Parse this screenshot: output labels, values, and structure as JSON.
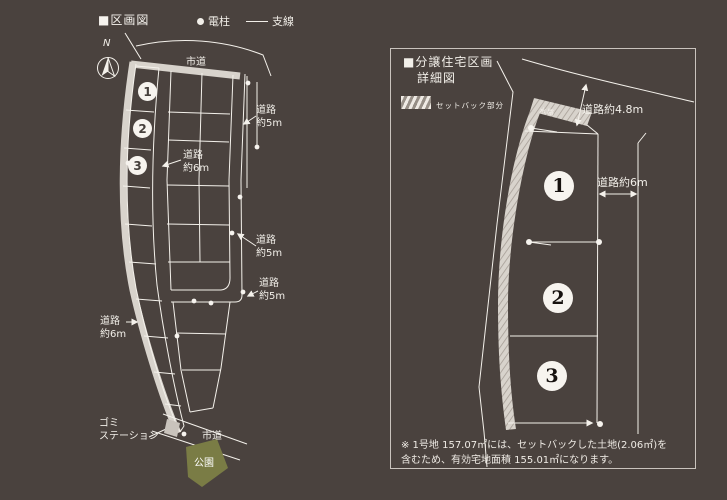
{
  "colors": {
    "background": "#4a423e",
    "line": "#f4f1eb",
    "road_band": "#d8d3cc",
    "park_green": "#7a7c45",
    "box_border": "#c9c3bd"
  },
  "overview": {
    "title": "■区画図",
    "legend": {
      "pole_label": "電柱",
      "wire_label": "支線"
    },
    "compass": "N",
    "road_city_top": "市道",
    "road_city_bottom": "市道",
    "park": "公園",
    "garbage_station": {
      "line1": "ゴミ",
      "line2": "ステーション"
    },
    "road6_center": {
      "line1": "道路",
      "line2": "約6m"
    },
    "road6_left": {
      "line1": "道路",
      "line2": "約6m"
    },
    "road5_a": {
      "line1": "道路",
      "line2": "約5m"
    },
    "road5_b": {
      "line1": "道路",
      "line2": "約5m"
    },
    "road5_c": {
      "line1": "道路",
      "line2": "約5m"
    },
    "lots": [
      "1",
      "2",
      "3"
    ]
  },
  "detail": {
    "title_line1": "■分譲住宅区画",
    "title_line2": "詳細図",
    "setback_label": "セットバック部分",
    "waterway": "水路",
    "road_4_8m": "道路約4.8m",
    "road_6m": "道路約6m",
    "lots": [
      "1",
      "2",
      "3"
    ],
    "note_line1": "※ 1号地 157.07㎡には、セットバックした土地(2.06㎡)を",
    "note_line2": "含むため、有効宅地面積 155.01㎡になります。"
  }
}
